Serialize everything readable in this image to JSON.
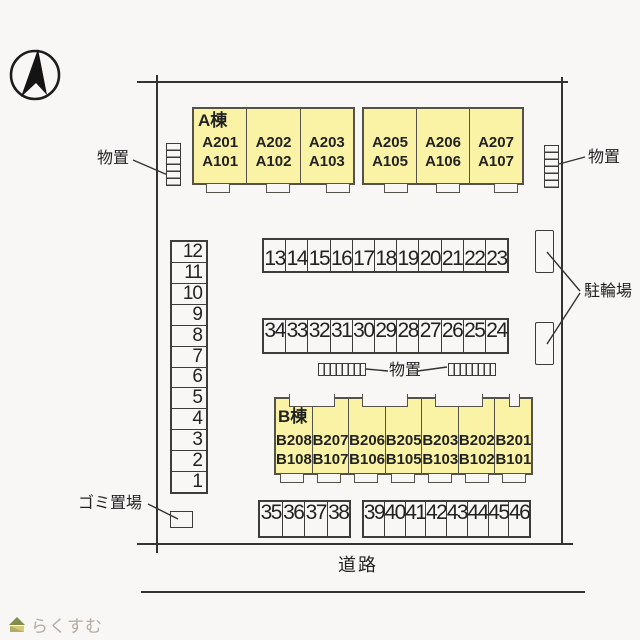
{
  "site": {
    "road_label": "道路",
    "logo_text": "らくすむ"
  },
  "labels": {
    "storage_left": "物置",
    "storage_right": "物置",
    "storage_middle": "物置",
    "bicycle_parking": "駐輪場",
    "garbage_area": "ゴミ置場"
  },
  "building_a": {
    "name": "A棟",
    "blocks": [
      {
        "units": [
          {
            "upper": "A201",
            "lower": "A101"
          },
          {
            "upper": "A202",
            "lower": "A102"
          },
          {
            "upper": "A203",
            "lower": "A103"
          }
        ]
      },
      {
        "units": [
          {
            "upper": "A205",
            "lower": "A105"
          },
          {
            "upper": "A206",
            "lower": "A106"
          },
          {
            "upper": "A207",
            "lower": "A107"
          }
        ]
      }
    ]
  },
  "building_b": {
    "name": "B棟",
    "units": [
      {
        "upper": "B208",
        "lower": "B108"
      },
      {
        "upper": "B207",
        "lower": "B107"
      },
      {
        "upper": "B206",
        "lower": "B106"
      },
      {
        "upper": "B205",
        "lower": "B105"
      },
      {
        "upper": "B203",
        "lower": "B103"
      },
      {
        "upper": "B202",
        "lower": "B102"
      },
      {
        "upper": "B201",
        "lower": "B101"
      }
    ]
  },
  "parking": {
    "left_column": [
      "12",
      "11",
      "10",
      "9",
      "8",
      "7",
      "6",
      "5",
      "4",
      "3",
      "2",
      "1"
    ],
    "top_row": [
      "13",
      "14",
      "15",
      "16",
      "17",
      "18",
      "19",
      "20",
      "21",
      "22",
      "23"
    ],
    "middle_row": [
      "34",
      "33",
      "32",
      "31",
      "30",
      "29",
      "28",
      "27",
      "26",
      "25",
      "24"
    ],
    "bottom_left_row": [
      "35",
      "36",
      "37",
      "38"
    ],
    "bottom_right_row": [
      "39",
      "40",
      "41",
      "42",
      "43",
      "44",
      "45",
      "46"
    ]
  },
  "colors": {
    "building_fill": "#faf3a6",
    "line": "#3c3c38",
    "logo_text": "#b3aaa3",
    "logo_roof": "#7f8d4f",
    "logo_body": "#d9cb74"
  }
}
